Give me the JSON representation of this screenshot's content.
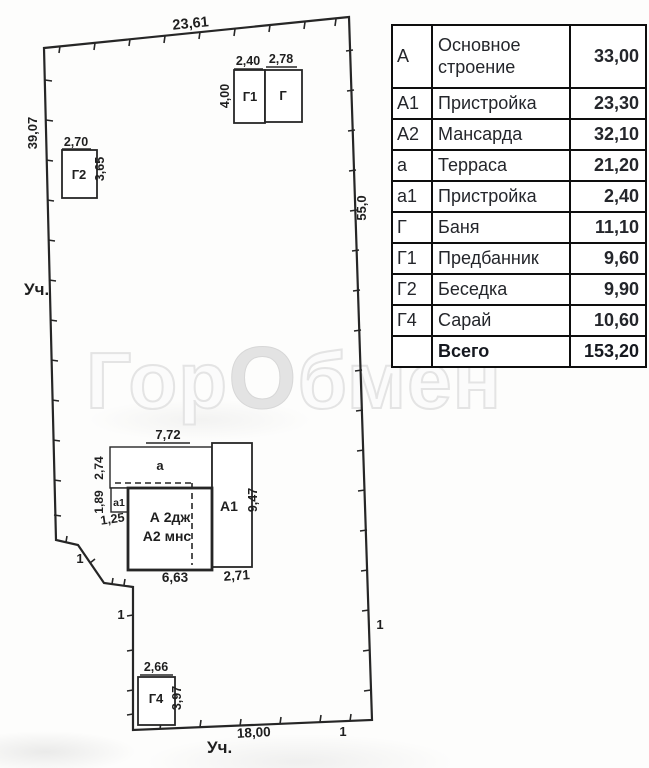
{
  "plan": {
    "boundary_dims": {
      "top": "23,61",
      "left": "39,07",
      "right": "55,0",
      "bottom": "18,00"
    },
    "plot_label_left": "Уч.",
    "plot_label_bottom": "Уч.",
    "marks": [
      "1",
      "1",
      "1",
      "1"
    ],
    "bath": {
      "g1_label": "Г1",
      "g_label": "Г",
      "g1_width": "2,40",
      "g_width": "2,78",
      "height": "4,00"
    },
    "gazebo": {
      "label": "Г2",
      "width": "2,70",
      "height": "3,65"
    },
    "shed": {
      "label": "Г4",
      "width": "2,66",
      "height": "3,97"
    },
    "house": {
      "terrace_label": "а",
      "annex_small_label": "а1",
      "annex_big_label": "А1",
      "main_line1": "А 2дж",
      "main_line2": "А2 мнс",
      "dim_top": "7,72",
      "dim_left_upper": "2,74",
      "dim_left_lower": "1,89",
      "dim_annex_small": "1,25",
      "dim_bottom_main": "6,63",
      "dim_bottom_annex": "2,71",
      "dim_right_annex": "9,47"
    }
  },
  "watermark": {
    "part1": "Гор",
    "part2": "О",
    "part3": "бмен"
  },
  "table": {
    "rows": [
      {
        "code": "А",
        "name": "Основное строение",
        "value": "33,00"
      },
      {
        "code": "А1",
        "name": "Пристройка",
        "value": "23,30"
      },
      {
        "code": "А2",
        "name": "Мансарда",
        "value": "32,10"
      },
      {
        "code": "а",
        "name": "Терраса",
        "value": "21,20"
      },
      {
        "code": "а1",
        "name": "Пристройка",
        "value": "2,40"
      },
      {
        "code": "Г",
        "name": "Баня",
        "value": "11,10"
      },
      {
        "code": "Г1",
        "name": "Предбанник",
        "value": "9,60"
      },
      {
        "code": "Г2",
        "name": "Беседка",
        "value": "9,90"
      },
      {
        "code": "Г4",
        "name": "Сарай",
        "value": "10,60"
      },
      {
        "code": "",
        "name": "Всего",
        "value": "153,20"
      }
    ]
  }
}
